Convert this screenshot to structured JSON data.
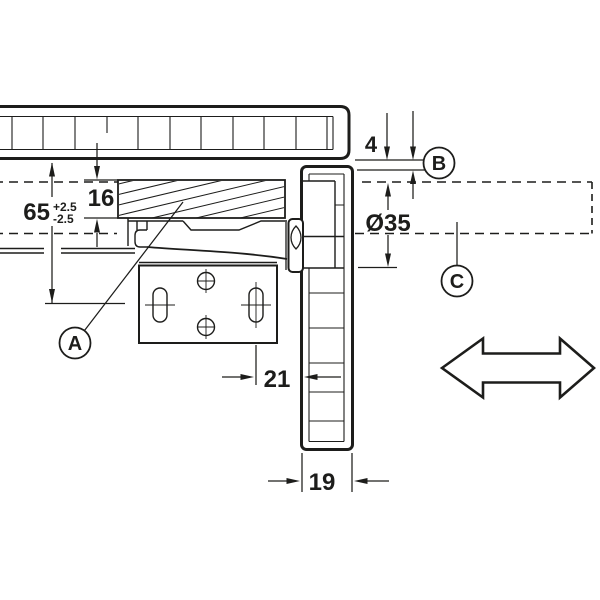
{
  "drawing": {
    "type": "hinge-mounting-cross-section",
    "colors": {
      "line": "#1d1d1b",
      "background": "#ffffff"
    },
    "labels": {
      "part_a": "A",
      "part_b": "B",
      "part_c": "C"
    },
    "dimensions": {
      "plate_distance": {
        "value": "65",
        "tolerance_plus": "+2.5",
        "tolerance_minus": "-2.5"
      },
      "block_thickness": "16",
      "top_gap": "4",
      "cup_diameter": "Ø35",
      "cup_edge_distance": "21",
      "door_thickness": "19"
    }
  }
}
